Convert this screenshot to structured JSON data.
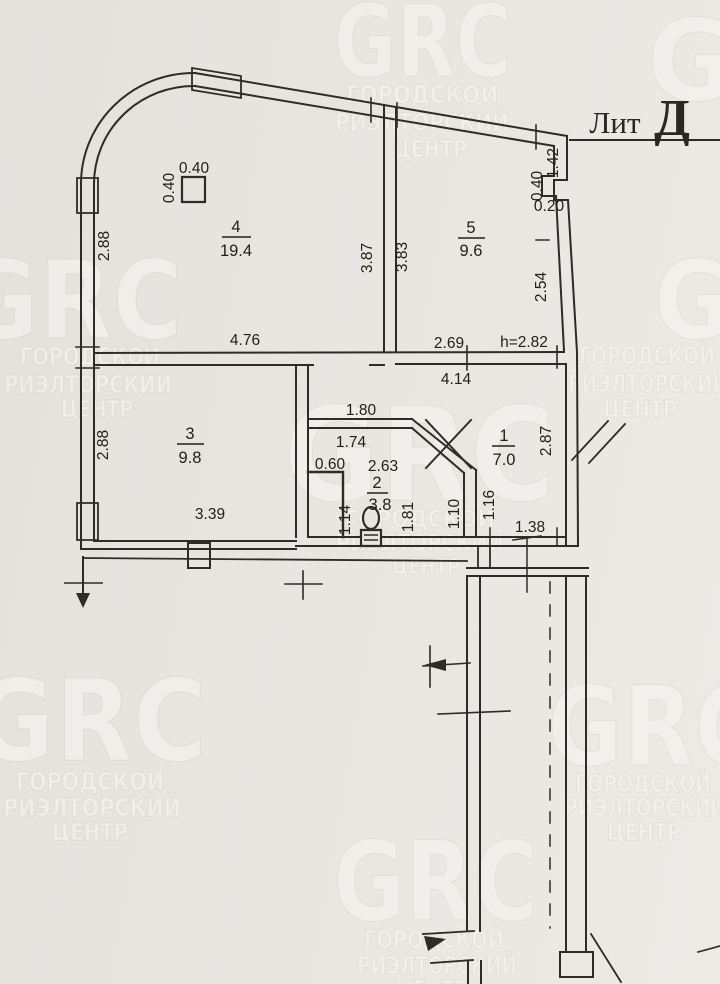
{
  "plan": {
    "building_label_prefix": "Лит",
    "building_letter": "Д",
    "ceiling_height_note": "h=2.82",
    "rooms": [
      {
        "number": "4",
        "area": "19.4"
      },
      {
        "number": "5",
        "area": "9.6"
      },
      {
        "number": "3",
        "area": "9.8"
      },
      {
        "number": "2",
        "area": "3.8"
      },
      {
        "number": "1",
        "area": "7.0"
      }
    ],
    "dimensions": {
      "column_top": "0.40",
      "column_side": "0.40",
      "room4_left": "2.88",
      "room4_bottom": "4.76",
      "partition45_left": "3.87",
      "partition45_right": "3.83",
      "niche_top": "1.42",
      "niche_mid": "0.40",
      "niche_low": "0.20",
      "room5_right": "2.54",
      "room5_bottom": "2.69",
      "corridor_top": "4.14",
      "room3_left": "2.88",
      "room3_bottom": "3.39",
      "hall_width": "1.80",
      "bath_top": "1.74",
      "closet_width": "0.60",
      "bath_diag": "2.63",
      "closet_height": "1.14",
      "bath_right": "1.81",
      "bath_wall": "1.10",
      "corridor_width": "1.16",
      "corridor_right": "2.87",
      "exit_width": "1.38"
    }
  },
  "watermark": {
    "logo": "GRC",
    "line1": "ГОРОДСКОЙ",
    "line2": "РИЭЛТОРСКИЙ",
    "line3": "ЦЕНТР"
  },
  "colors": {
    "paper": "#e9e6e2",
    "ink": "#2e2b28",
    "watermark": "#f6f4f0"
  }
}
